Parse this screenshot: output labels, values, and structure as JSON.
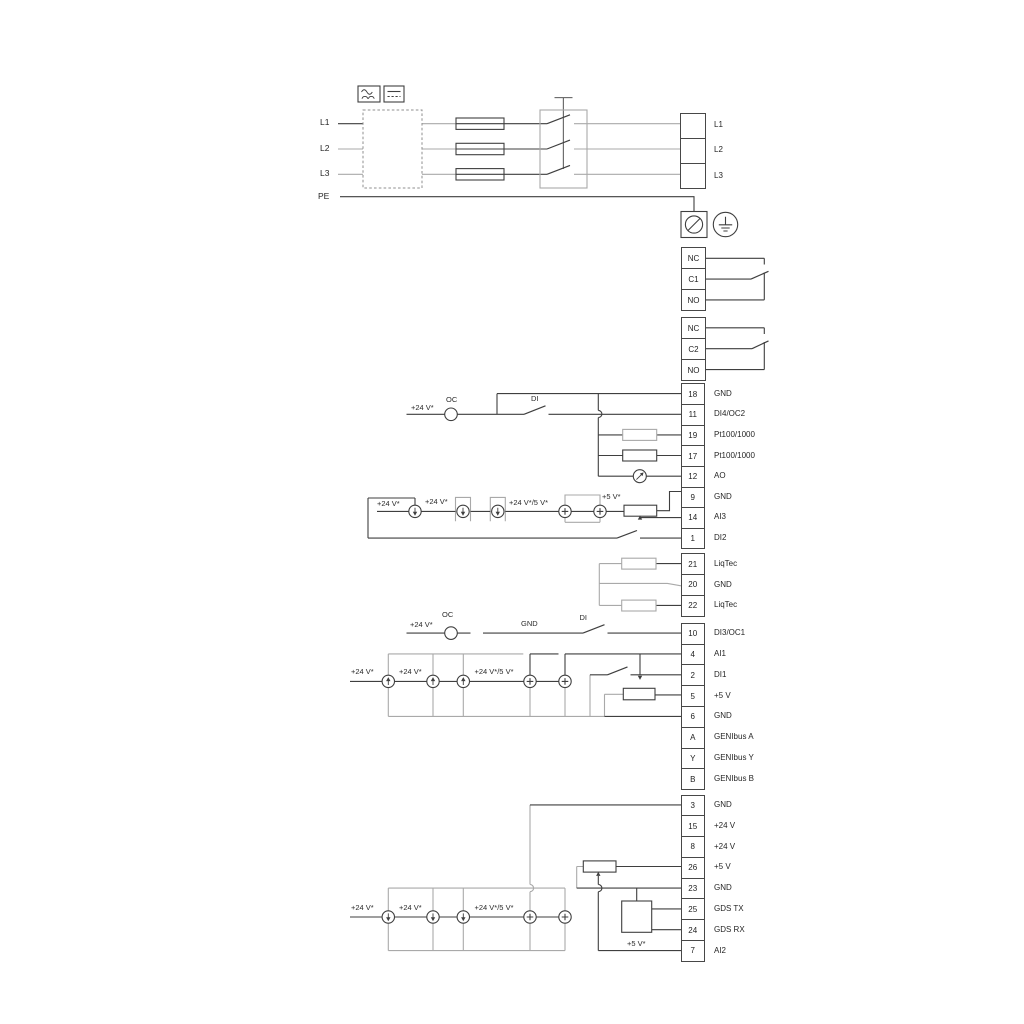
{
  "labels": {
    "v24": "+24 V*",
    "v24_5": "+24 V*/5 V*",
    "v5": "+5 V*",
    "oc": "OC",
    "di": "DI",
    "gnd": "GND"
  },
  "power": {
    "inputs": [
      "L1",
      "L2",
      "L3",
      "PE"
    ],
    "outputs": [
      "L1",
      "L2",
      "L3"
    ]
  },
  "relays": {
    "relay1": [
      "NC",
      "C1",
      "NO"
    ],
    "relay2": [
      "NC",
      "C2",
      "NO"
    ]
  },
  "terminals": {
    "group1": [
      {
        "n": "18",
        "label": "GND"
      },
      {
        "n": "11",
        "label": "DI4/OC2"
      },
      {
        "n": "19",
        "label": "Pt100/1000"
      },
      {
        "n": "17",
        "label": "Pt100/1000"
      },
      {
        "n": "12",
        "label": "AO"
      },
      {
        "n": "9",
        "label": "GND"
      },
      {
        "n": "14",
        "label": "AI3"
      },
      {
        "n": "1",
        "label": "DI2"
      }
    ],
    "group2": [
      {
        "n": "21",
        "label": "LiqTec"
      },
      {
        "n": "20",
        "label": "GND"
      },
      {
        "n": "22",
        "label": "LiqTec"
      }
    ],
    "group3": [
      {
        "n": "10",
        "label": "DI3/OC1"
      },
      {
        "n": "4",
        "label": "AI1"
      },
      {
        "n": "2",
        "label": "DI1"
      },
      {
        "n": "5",
        "label": "+5 V"
      },
      {
        "n": "6",
        "label": "GND"
      },
      {
        "n": "A",
        "label": "GENIbus A"
      },
      {
        "n": "Y",
        "label": "GENIbus Y"
      },
      {
        "n": "B",
        "label": "GENIbus B"
      }
    ],
    "group4": [
      {
        "n": "3",
        "label": "GND"
      },
      {
        "n": "15",
        "label": "+24 V"
      },
      {
        "n": "8",
        "label": "+24 V"
      },
      {
        "n": "26",
        "label": "+5 V"
      },
      {
        "n": "23",
        "label": "GND"
      },
      {
        "n": "25",
        "label": "GDS TX"
      },
      {
        "n": "24",
        "label": "GDS RX"
      },
      {
        "n": "7",
        "label": "AI2"
      }
    ]
  },
  "colors": {
    "wire": "#3f3f3f",
    "wire_gray": "#a9a9a9"
  }
}
